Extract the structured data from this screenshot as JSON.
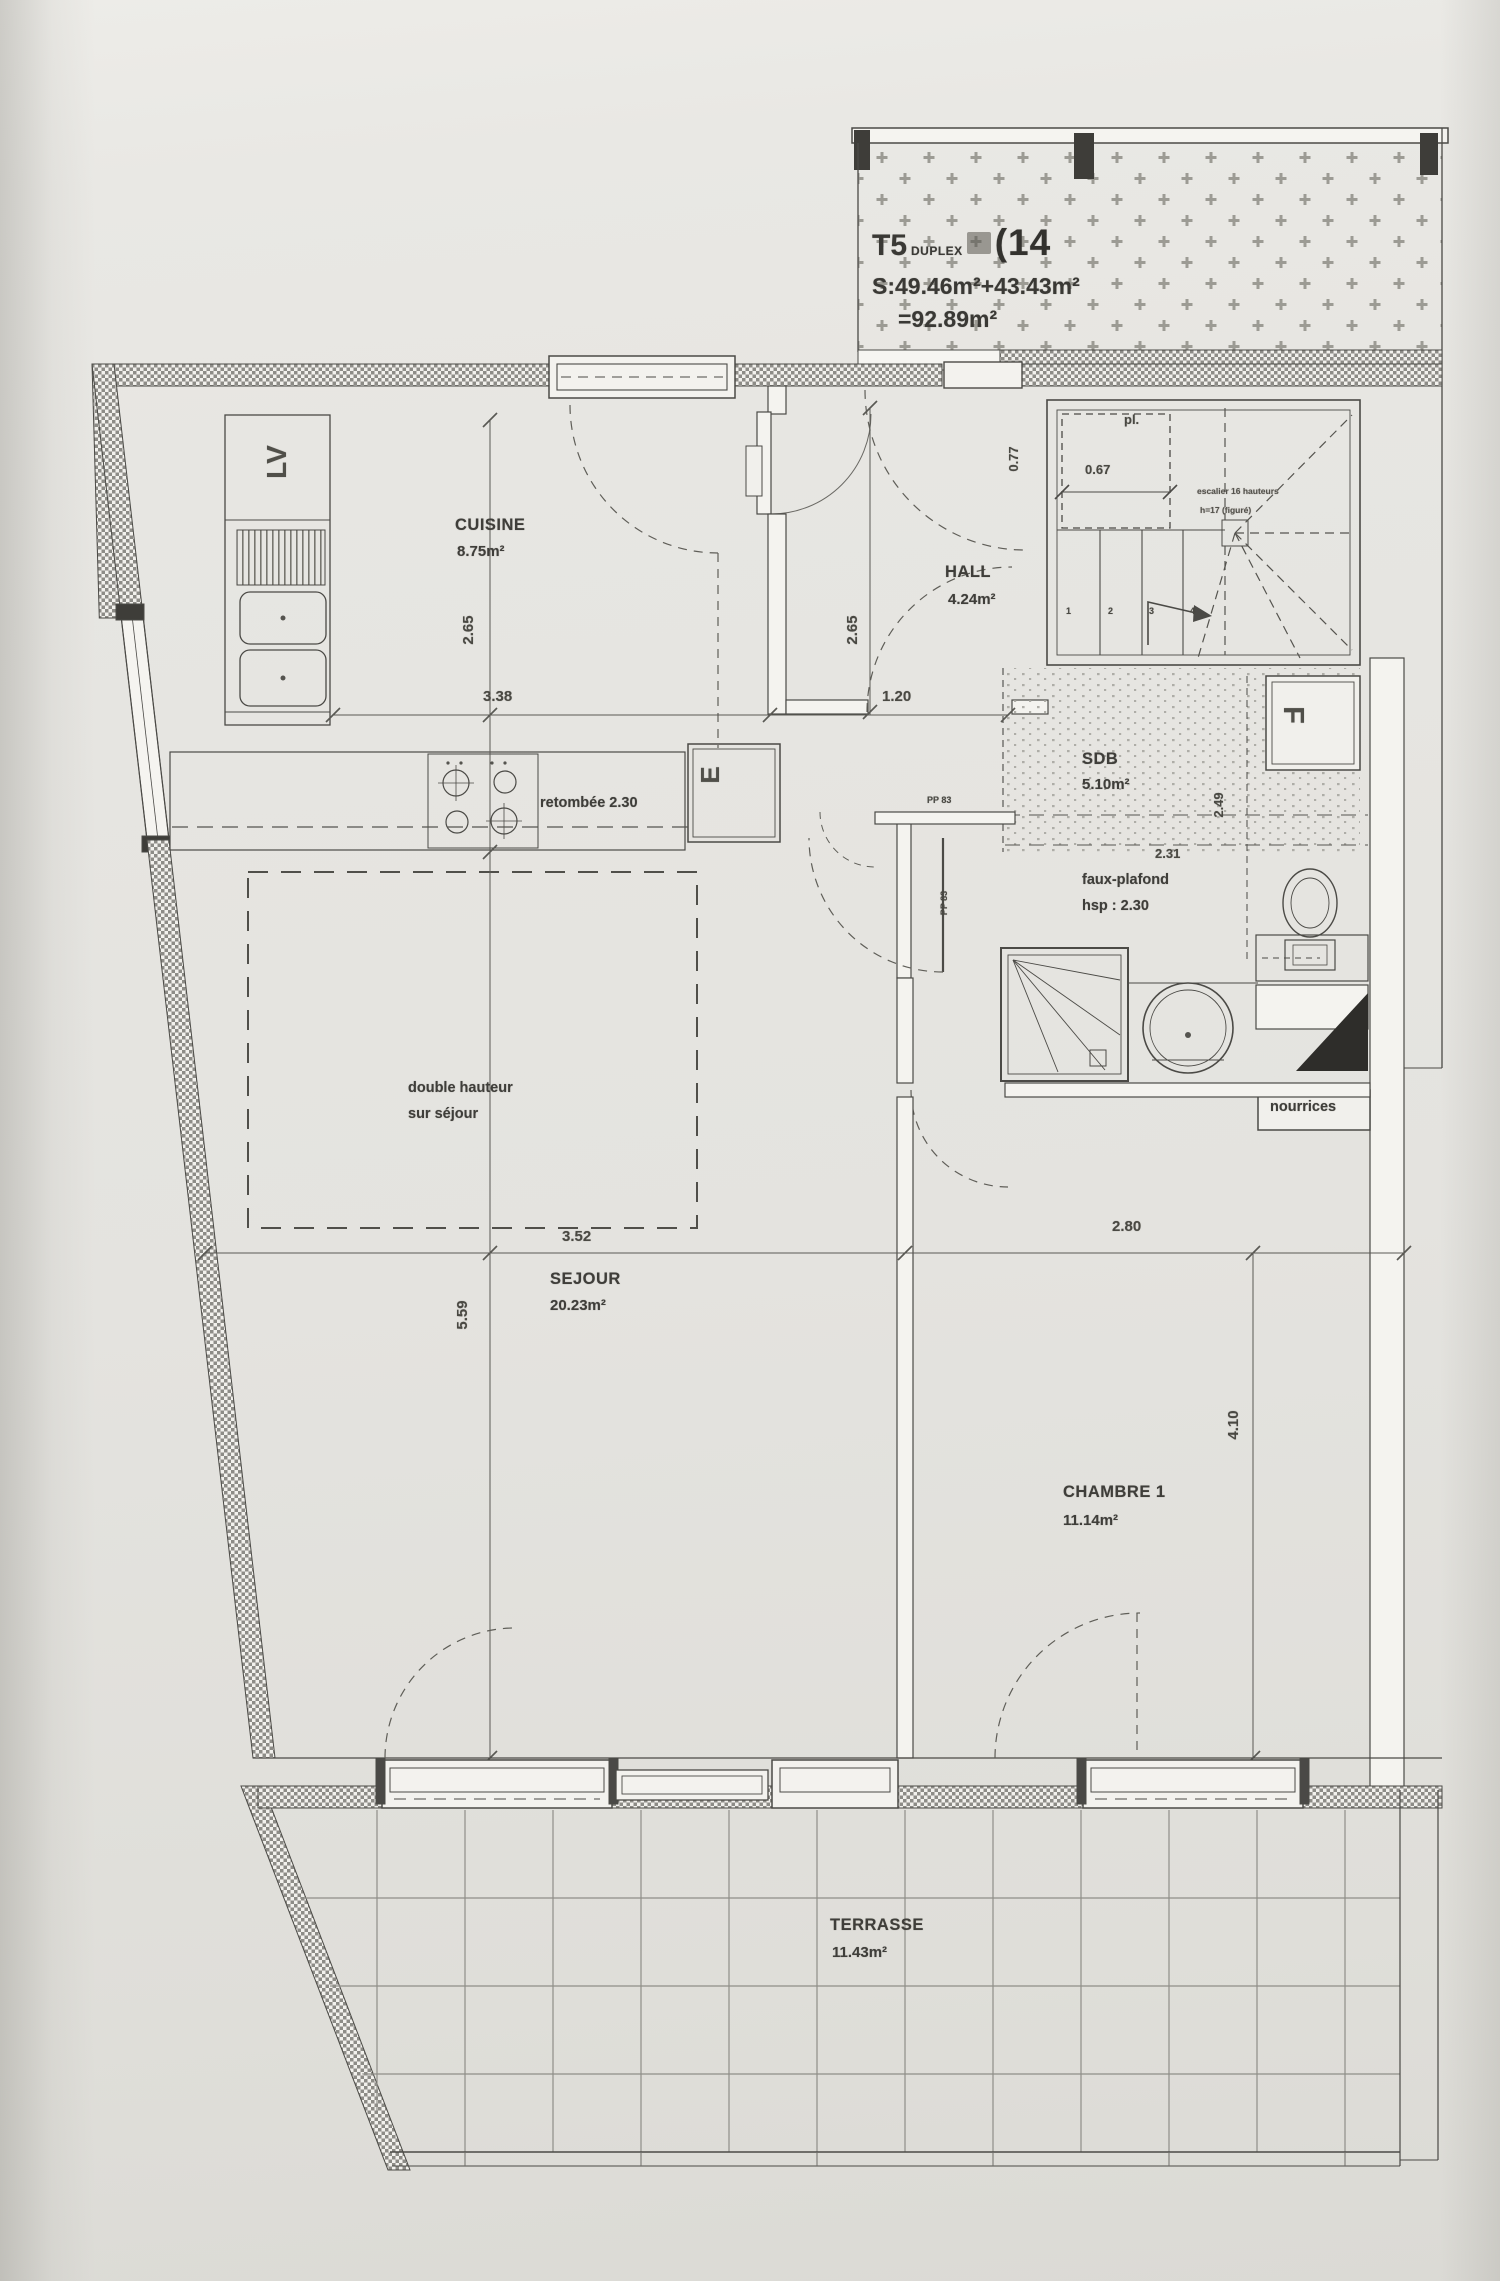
{
  "title": {
    "type": "T5",
    "subtype": "DUPLEX",
    "lot": "(14",
    "surface_line": "S:49.46m²+43.43m²",
    "total_line": "=92.89m²"
  },
  "rooms": {
    "cuisine": {
      "name": "CUISINE",
      "area": "8.75m²"
    },
    "hall": {
      "name": "HALL",
      "area": "4.24m²"
    },
    "sdb": {
      "name": "SDB",
      "area": "5.10m²"
    },
    "sejour": {
      "name": "SEJOUR",
      "area": "20.23m²"
    },
    "chambre1": {
      "name": "CHAMBRE 1",
      "area": "11.14m²"
    },
    "terrasse": {
      "name": "TERRASSE",
      "area": "11.43m²"
    }
  },
  "dimensions": {
    "cuisine_width": "3.38",
    "cuisine_height": "2.65",
    "hall_width": "1.20",
    "hall_height": "2.65",
    "entry_door": "0.77",
    "closet": "0.67",
    "sdb_width": "2.31",
    "sdb_height": "2.49",
    "sejour_width": "3.52",
    "sejour_height": "5.59",
    "chambre_width": "2.80",
    "chambre_height": "4.10"
  },
  "annotations": {
    "retombee": "retombée 2.30",
    "faux_plafond_line1": "faux-plafond",
    "faux_plafond_line2": "hsp : 2.30",
    "double_hauteur_line1": "double hauteur",
    "double_hauteur_line2": "sur séjour",
    "nourrices": "nourrices",
    "placard": "pl.",
    "dishwasher": "LV",
    "appliance_e": "E",
    "closet_f": "F",
    "stair_line1": "escalier 16 hauteurs",
    "stair_line2": "h=17 (figuré)",
    "door_pp83_top": "PP 83",
    "door_pp83_side": "PP 83",
    "step_numbers": [
      "1",
      "2",
      "3",
      "4"
    ]
  },
  "colors": {
    "ink": "#4b4a46",
    "paper": "#e7e6e2",
    "hatch": "#8d8c87"
  }
}
